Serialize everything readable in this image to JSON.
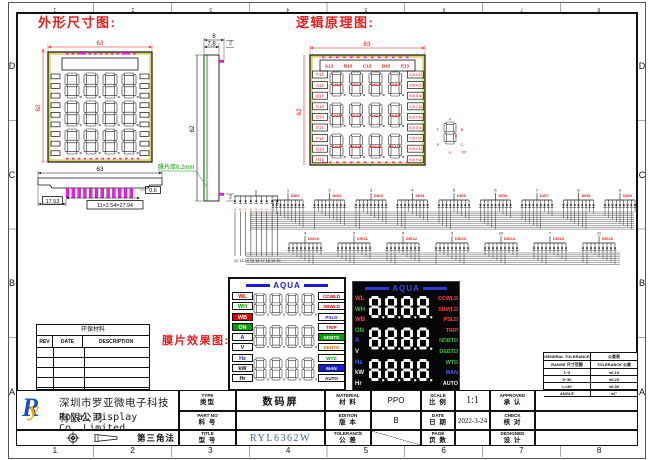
{
  "frame": {
    "top_numbers": [
      "1",
      "2",
      "3",
      "4",
      "5",
      "6",
      "7",
      "8"
    ],
    "bottom_numbers": [
      "1",
      "2",
      "3",
      "4",
      "5",
      "6",
      "7",
      "8"
    ],
    "left_letters": [
      "D",
      "C",
      "B",
      "A"
    ],
    "right_letters": [
      "D",
      "C",
      "B",
      "A"
    ]
  },
  "titles": {
    "outline": "外形尺寸图:",
    "logic": "逻辑原理图:",
    "membrane": "膜片效果图:"
  },
  "outline_view": {
    "dim_width": "63",
    "dim_height": "62",
    "profile": {
      "dim_width": "63",
      "dim_left": "17.53",
      "dim_right": "0.6",
      "dim_pitch": "11×2.54=27.94"
    },
    "side": {
      "dim_outer": "8",
      "dim_inner": "7.8",
      "dim_height": "62",
      "dim_tail_top": "2",
      "dim_tail_bottom": "2",
      "film_note": "膜片厚0.2mm"
    }
  },
  "logic_view": {
    "dim_width": "63",
    "dim_height": "62",
    "top_labels": [
      "A13",
      "B13",
      "C13",
      "D13",
      "E13"
    ],
    "left_labels": [
      "F13",
      "A14",
      "B14",
      "C14",
      "D14",
      "E14",
      "F14",
      "G14",
      "H14"
    ],
    "right_labels": [
      "G13 H13",
      "A15 A16",
      "B15 B16",
      "C15 C16",
      "D15 D16",
      "E15 E16",
      "F15 F16",
      "G15 G16",
      "H15 H16"
    ],
    "digit_labels": [
      "DIG1",
      "DIG2",
      "DIG3",
      "DIG4",
      "DIG5",
      "DIG6",
      "DIG7",
      "DIG8",
      "DIG9",
      "DIG10",
      "DIG11",
      "DIG12"
    ],
    "seg_ref": {
      "a": "A",
      "b": "B",
      "c": "C",
      "d": "D",
      "e": "E",
      "f": "F",
      "g": "G",
      "dp": "DP"
    }
  },
  "schematic": {
    "seg_letters": [
      "A",
      "B",
      "C",
      "D",
      "E",
      "F",
      "G",
      "H",
      "I"
    ],
    "left_pin_numbers": "12 13 14 15 16 17 18 19 20",
    "row1": [
      {
        "pin": "1",
        "label": "DIG1"
      },
      {
        "pin": "2",
        "label": "DIG2"
      },
      {
        "pin": "3",
        "label": "DIG3"
      },
      {
        "pin": "4",
        "label": "DIG4"
      },
      {
        "pin": "5",
        "label": "DIG5"
      },
      {
        "pin": "6",
        "label": "DIG6"
      },
      {
        "pin": "7",
        "label": "DIG7"
      },
      {
        "pin": "8",
        "label": "DIG8"
      },
      {
        "pin": "9",
        "label": "DIG9"
      }
    ],
    "row2": [
      {
        "pin": "4",
        "label": "DIG10"
      },
      {
        "pin": "2",
        "label": "DIG11"
      },
      {
        "pin": "9",
        "label": "DIG12"
      },
      {
        "pin": "3",
        "label": "DIG13"
      },
      {
        "pin": "10",
        "label": "DIG14"
      },
      {
        "pin": "7",
        "label": "DIG15"
      },
      {
        "pin": "11",
        "label": "DIG16"
      }
    ]
  },
  "membrane_white": {
    "brand": "AQUA",
    "left": [
      {
        "text": "WL",
        "color": "#e00000",
        "bg": ""
      },
      {
        "text": "WH",
        "color": "#00a000",
        "bg": ""
      },
      {
        "text": "WB",
        "color": "#ffffff",
        "bg": "#e00000"
      },
      {
        "text": "ON",
        "color": "#ffffff",
        "bg": "#00a000"
      },
      {
        "text": "A",
        "color": "#1b1bd6",
        "bg": ""
      },
      {
        "text": "V",
        "color": "#111111",
        "bg": ""
      },
      {
        "text": "Hz",
        "color": "#1b1bd6",
        "bg": ""
      },
      {
        "text": "kW",
        "color": "#111111",
        "bg": ""
      },
      {
        "text": "Hr",
        "color": "#111111",
        "bg": ""
      }
    ],
    "right": [
      {
        "text": "CCWLD",
        "color": "#e00000",
        "bg": ""
      },
      {
        "text": "SBWLD",
        "color": "#e00000",
        "bg": ""
      },
      {
        "text": "PSLD",
        "color": "#1b1bd6",
        "bg": ""
      },
      {
        "text": "TRIP",
        "color": "#e00000",
        "bg": ""
      },
      {
        "text": "NDBTD",
        "color": "#ffffff",
        "bg": "#00a000"
      },
      {
        "text": "DEBTD",
        "color": "#cc7700",
        "bg": ""
      },
      {
        "text": "WTD",
        "color": "#00a000",
        "bg": ""
      },
      {
        "text": "MAN",
        "color": "#ffffff",
        "bg": "#1b1bd6"
      },
      {
        "text": "AUTO",
        "color": "#111111",
        "bg": ""
      }
    ]
  },
  "membrane_dark": {
    "brand": "AQUA",
    "left": [
      {
        "text": "WL",
        "color": "#ff3b3b"
      },
      {
        "text": "WH",
        "color": "#3bbb3b"
      },
      {
        "text": "WB",
        "color": "#ff3b3b"
      },
      {
        "text": "ON",
        "color": "#3bbb3b"
      },
      {
        "text": "A",
        "color": "#4a5cff"
      },
      {
        "text": "V",
        "color": "#eeeeee"
      },
      {
        "text": "Hz",
        "color": "#4a5cff"
      },
      {
        "text": "kW",
        "color": "#eeeeee"
      },
      {
        "text": "Hr",
        "color": "#eeeeee"
      }
    ],
    "right": [
      {
        "text": "CCWLD",
        "color": "#ff3b3b"
      },
      {
        "text": "SBWLD",
        "color": "#ff3b3b"
      },
      {
        "text": "PSLD",
        "color": "#ff3b3b"
      },
      {
        "text": "TRIP",
        "color": "#ff3b3b"
      },
      {
        "text": "NDBTD",
        "color": "#3bbb3b"
      },
      {
        "text": "DEBTD",
        "color": "#3bbb3b"
      },
      {
        "text": "WTD",
        "color": "#3bbb3b"
      },
      {
        "text": "MAN",
        "color": "#4a5cff"
      },
      {
        "text": "AUTO",
        "color": "#eeeeee"
      }
    ]
  },
  "eco_table": {
    "title": "环保材料",
    "headers": [
      "REV",
      "DATE",
      "DESCRIPTION"
    ]
  },
  "company": {
    "logo_r": "R",
    "logo_y": "y",
    "name_cn": "深圳市罗亚微电子科技有限公司",
    "name_en": "Royal Display Co.,Limited",
    "projection_label": "第三角法"
  },
  "title_block": {
    "type": {
      "en": "TYPE",
      "cn": "类型",
      "value": "数码屏"
    },
    "part_no": {
      "en": "PART NO",
      "cn": "料 号",
      "value": ""
    },
    "title": {
      "en": "TITLE",
      "cn": "型 号",
      "value": "RYL6362W"
    },
    "material": {
      "en": "MATERIAL",
      "cn": "材 料",
      "value": "PPO"
    },
    "edition": {
      "en": "EDITION",
      "cn": "版 本",
      "value": "B"
    },
    "tolerance": {
      "en": "TOLERANCE",
      "cn": "公 差",
      "value": ""
    },
    "scale": {
      "en": "SCALE",
      "cn": "比 例",
      "value": "1:1"
    },
    "date": {
      "en": "DATE",
      "cn": "日 期",
      "value": "2022-3-24"
    },
    "page": {
      "en": "PAGE",
      "cn": "页 数",
      "value": ""
    },
    "approved": {
      "en": "APPROVED",
      "cn": "承 认",
      "value": ""
    },
    "check": {
      "en": "CHECK",
      "cn": "核 对",
      "value": ""
    },
    "designed": {
      "en": "DESIGNED",
      "cn": "设 计",
      "value": ""
    }
  },
  "general_tolerance": {
    "title_en": "GENERAL TOLERANCE",
    "title_cn": "公差表",
    "headers": [
      "RANGE 尺寸范围",
      "TOLERANCE 公差"
    ],
    "rows": [
      [
        "1~5",
        "±0.15"
      ],
      [
        "5~30",
        "±0.20"
      ],
      [
        "L>30",
        "±0.30"
      ],
      [
        "ANGLE",
        "±2°"
      ]
    ]
  },
  "colors": {
    "accent_red": "#e02020",
    "magenta": "#e820e8",
    "green": "#00a000",
    "brand_blue": "#1b1bd6",
    "panel_yellow": "#ddd66a",
    "model_blue": "#45639b"
  }
}
